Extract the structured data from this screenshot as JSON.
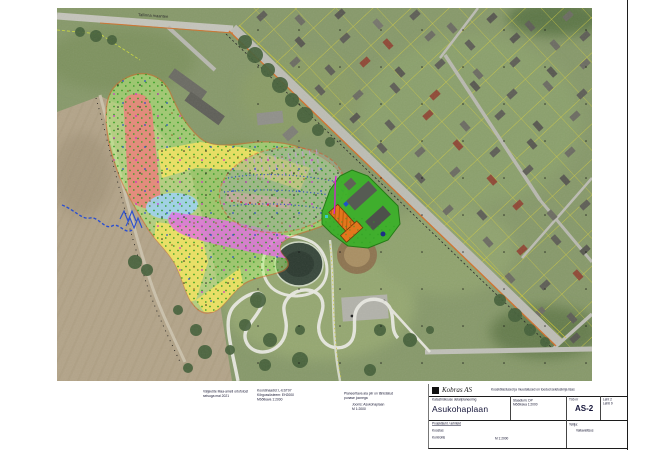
{
  "map": {
    "road_label": "Tallinna maantee"
  },
  "zones": {
    "blob": "#b7ef7d",
    "boundary": "#d4702a",
    "red_zone": "#e8857c",
    "yellow_zone": "#f2e263",
    "cyan_zone": "#9ed2ee",
    "magenta_zone": "#e26ee2",
    "pink_band": "#f2a8a4",
    "survey_oval": "#9fae9d",
    "plant_green": "#3cb02a",
    "building_orange": "#e2761c"
  },
  "notes": {
    "block1": [
      "Väljavõte Maa-ameti ortofotost",
      "seisuga mai 2021"
    ],
    "block2": [
      "Koordinaadid: L-EST97",
      "Kõrgussüsteem: EH2000",
      "Mõõtkava 1:2000"
    ],
    "block3": [
      "Planeeritava ala piir on tähistatud",
      "punase joonega"
    ],
    "block4": [
      "Joonis: Asukohaplaan",
      "M 1:2000"
    ]
  },
  "title_block": {
    "company": "Kobras AS",
    "top_note": "Kooskõlastused ja muudatused on toodud seletuskirja lisas",
    "proj_line": "Katastriüksuse detailplaneering",
    "title": "Asukohaplaan",
    "mid_line1": "Staadium: DP",
    "mid_line2": "Mõõtkava 1:2000",
    "work_label": "Töö nr",
    "work_no": "AS-2",
    "right_line1": "Leht 2",
    "right_line2": "Lehti 9",
    "left_head": "Projektijuht / arhitekt",
    "left_l2": "Koostas",
    "left_l3": "Kontrollis",
    "client_label": "Tellija:",
    "client_val": "Vallavalitsus",
    "foot": "M 1:2000"
  }
}
